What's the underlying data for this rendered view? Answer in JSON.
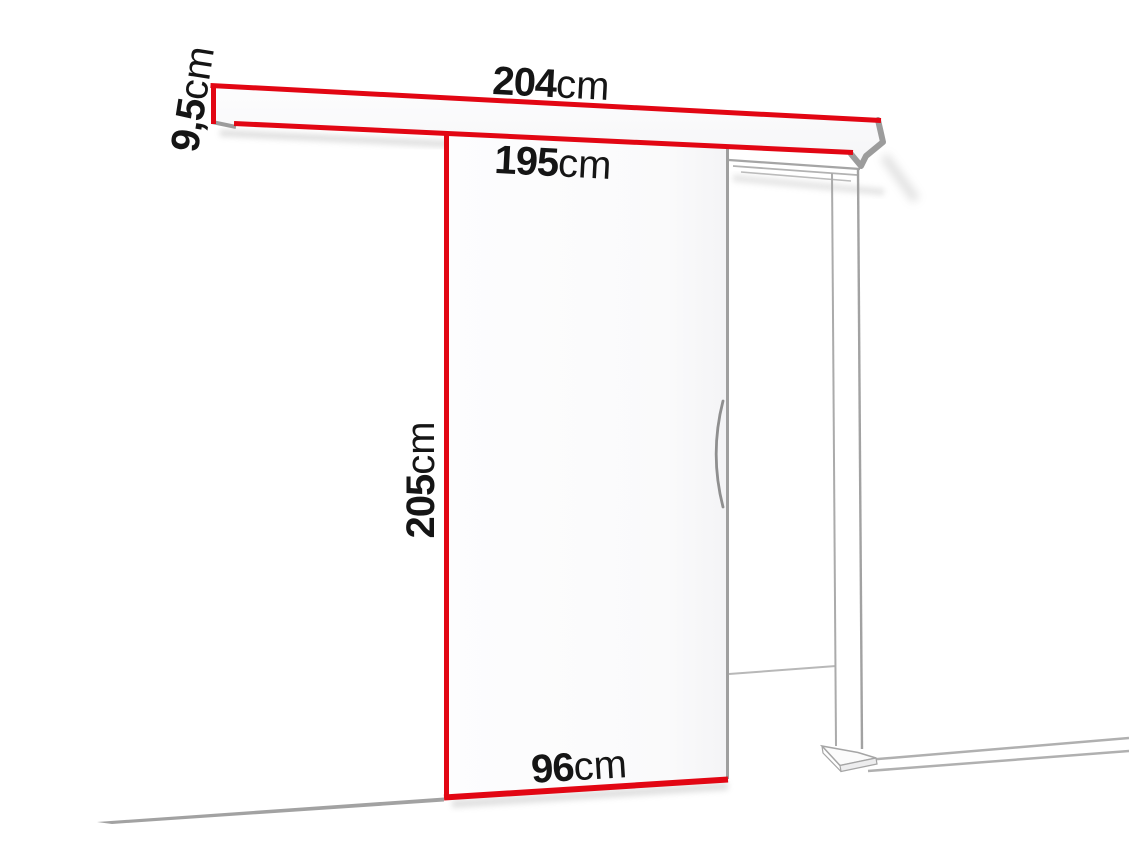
{
  "diagram": {
    "labels": {
      "track_width": {
        "value": "204",
        "unit": "cm"
      },
      "track_height": {
        "value": "9,5",
        "unit": "cm"
      },
      "clear_width": {
        "value": "195",
        "unit": "cm"
      },
      "door_height": {
        "value": "205",
        "unit": "cm"
      },
      "door_width": {
        "value": "96",
        "unit": "cm"
      }
    },
    "colors": {
      "accent_red": "#e20613",
      "line_gray": "#9b9b9b",
      "text_black": "#151515",
      "background": "#ffffff"
    }
  }
}
